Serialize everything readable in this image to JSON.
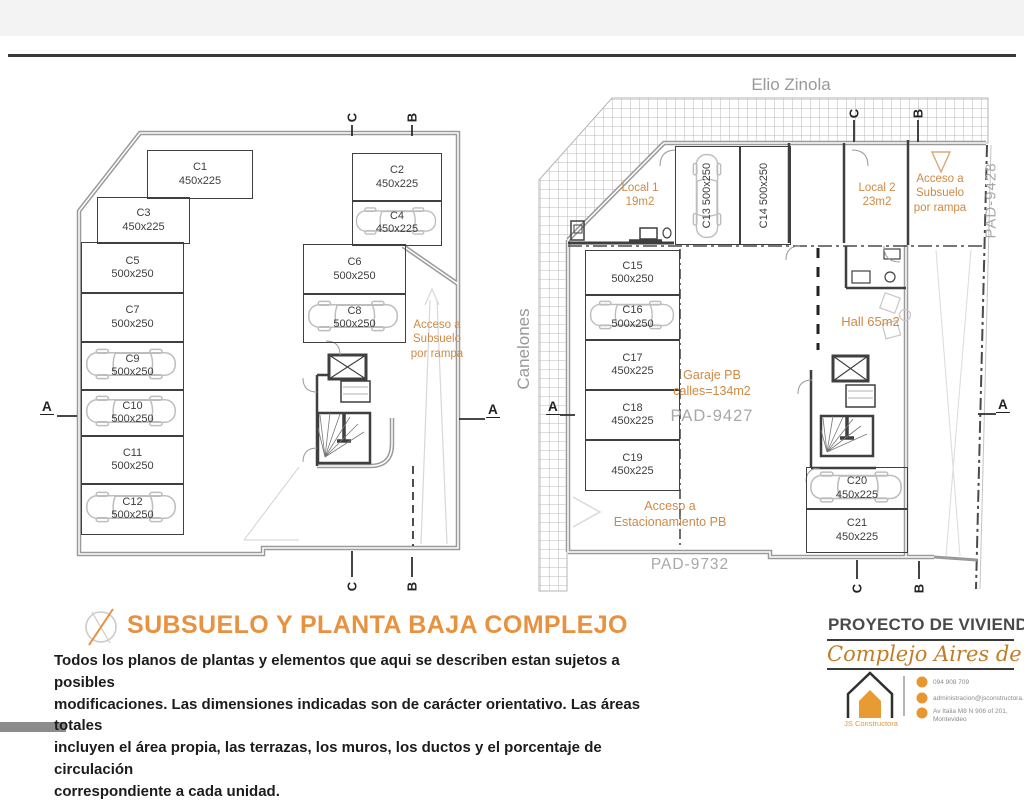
{
  "streets": {
    "top": "Elio Zinola",
    "left": "Canelones"
  },
  "subsuelo": {
    "stalls": [
      {
        "id": "C1",
        "dim": "450x225"
      },
      {
        "id": "C3",
        "dim": "450x225"
      },
      {
        "id": "C5",
        "dim": "500x250"
      },
      {
        "id": "C7",
        "dim": "500x250"
      },
      {
        "id": "C9",
        "dim": "500x250"
      },
      {
        "id": "C10",
        "dim": "500x250"
      },
      {
        "id": "C11",
        "dim": "500x250"
      },
      {
        "id": "C12",
        "dim": "500x250"
      },
      {
        "id": "C2",
        "dim": "450x225"
      },
      {
        "id": "C4",
        "dim": "450x225"
      },
      {
        "id": "C6",
        "dim": "500x250"
      },
      {
        "id": "C8",
        "dim": "500x250"
      }
    ],
    "ramp_label": "Acceso a\nSubsuelo\npor rampa",
    "markers": {
      "top_c": "C",
      "top_b": "B",
      "bottom_c": "C",
      "bottom_b": "B",
      "left_a": "A",
      "right_a": "A"
    }
  },
  "planta_baja": {
    "stalls": [
      {
        "id": "C13",
        "dim": "500x250"
      },
      {
        "id": "C14",
        "dim": "500x250"
      },
      {
        "id": "C15",
        "dim": "500x250"
      },
      {
        "id": "C16",
        "dim": "500x250"
      },
      {
        "id": "C17",
        "dim": "450x225"
      },
      {
        "id": "C18",
        "dim": "450x225"
      },
      {
        "id": "C19",
        "dim": "450x225"
      },
      {
        "id": "C20",
        "dim": "450x225"
      },
      {
        "id": "C21",
        "dim": "450x225"
      }
    ],
    "rooms": {
      "local1": "Local 1\n19m2",
      "local2": "Local 2\n23m2",
      "hall": "Hall 65m2",
      "garaje": "Garaje PB\ncalles=134m2"
    },
    "ramp_label": "Acceso a\nSubsuelo\npor rampa",
    "acceso_estacionamiento": "Acceso a\nEstacionamiento PB",
    "pads": {
      "right": "PAD-9428",
      "center": "PAD-9427",
      "bottom": "PAD-9732"
    },
    "markers": {
      "top_c": "C",
      "top_b": "B",
      "bottom_c": "C",
      "bottom_b": "B",
      "left_a": "A",
      "right_a": "A"
    }
  },
  "footer": {
    "title": "SUBSUELO Y PLANTA BAJA COMPLEJO",
    "disclaimer": "Todos los planos de plantas y elementos que aqui se describen estan sujetos a posibles\nmodificaciones.  Las dimensiones indicadas son de carácter orientativo. Las áreas totales\nincluyen el área propia, las terrazas, los muros, los ductos y el porcentaje de circulación\ncorrespondiente a cada unidad.",
    "project_heading": "PROYECTO DE VIVIENDAS",
    "project_name": "Complejo Aires de Pando",
    "logo_text": "JS Constructora",
    "contact": {
      "phone": "094 908 709",
      "email": "administracion@jsconstructora.com",
      "address": "Av Italia M8 N 906 of 201,\nMontevideo"
    }
  },
  "colors": {
    "accent_orange": "#E8913F",
    "label_orange": "#CE8A45",
    "plan_gray": "#9A9A9A",
    "dark_wall": "#3F3F3F",
    "pad_gray": "#A8A8A8",
    "name_gold": "#C07D28"
  }
}
